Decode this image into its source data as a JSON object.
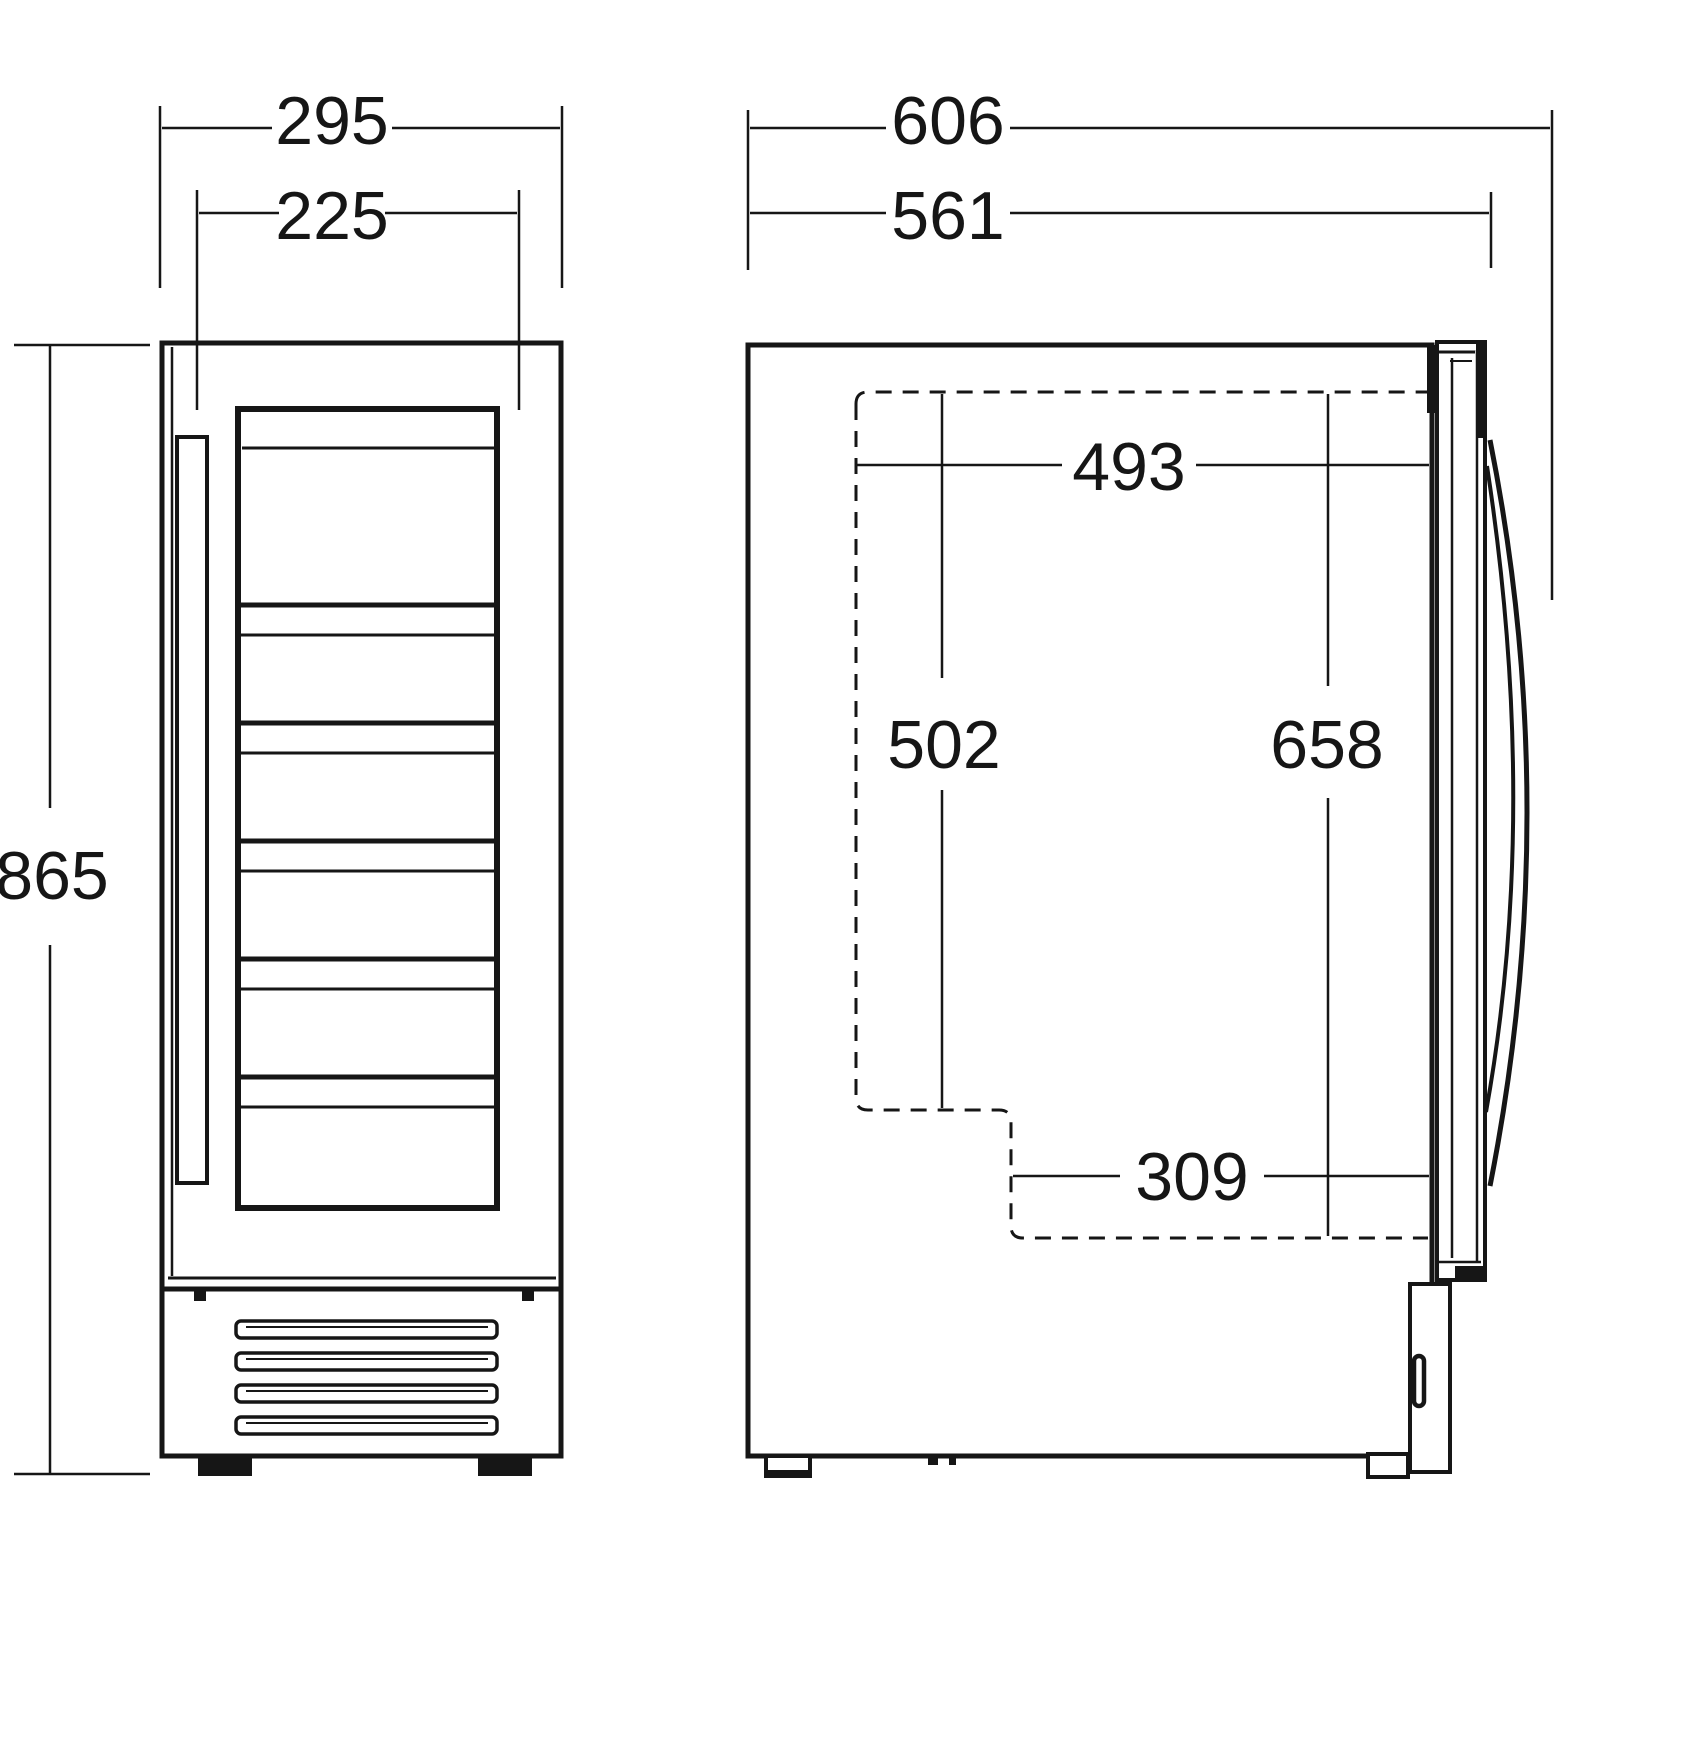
{
  "front_view": {
    "overall_width": "295",
    "inner_width": "225",
    "overall_height": "865"
  },
  "side_view": {
    "overall_depth": "606",
    "body_depth": "561",
    "recess_depth": "493",
    "recess_height_front": "502",
    "recess_height_rear": "658",
    "recess_depth_lower": "309"
  }
}
